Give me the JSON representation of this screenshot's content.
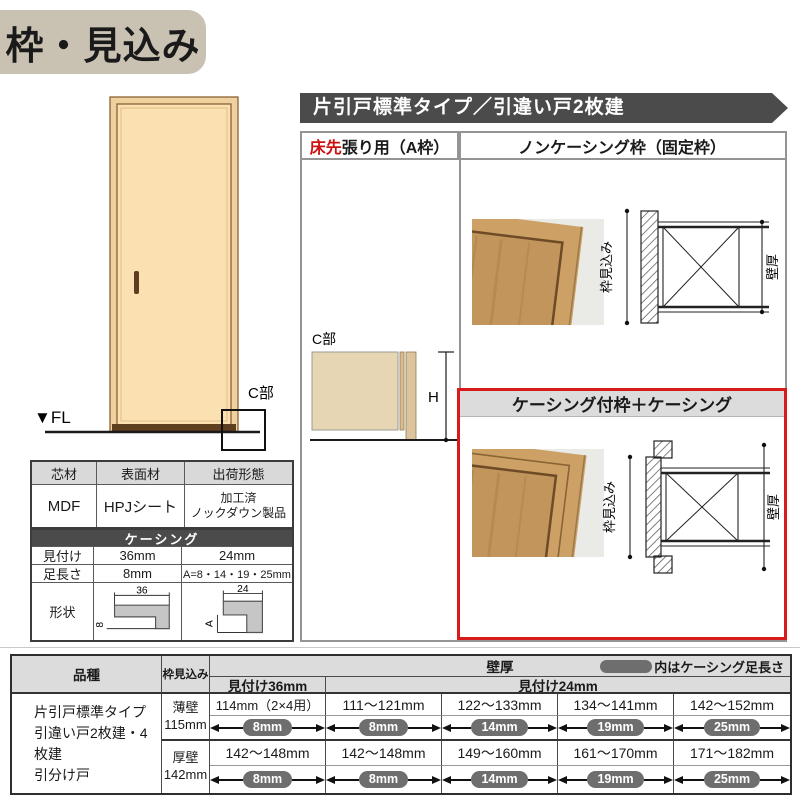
{
  "title": "枠・見込み",
  "colors": {
    "accent_red": "#cc1111",
    "border_red": "#d71a1a",
    "bar_gray": "#4b4b4b",
    "pill_gray": "#6e6e6e",
    "header_gray": "#dcdcdc",
    "title_bg": "#c9c1b2",
    "door_tan": "#fbe0b2"
  },
  "elevation": {
    "fl_label": "▼FL",
    "c_label": "C部"
  },
  "material_table": {
    "headers": [
      "芯材",
      "表面材",
      "出荷形態"
    ],
    "core": "MDF",
    "surface": "HPJシート",
    "shipping_line1": "加工済",
    "shipping_line2": "ノックダウン製品"
  },
  "casing_table": {
    "title": "ケーシング",
    "row_mitsuke": {
      "label": "見付け",
      "v36": "36mm",
      "v24": "24mm"
    },
    "row_ashinaga": {
      "label": "足長さ",
      "v36": "8mm",
      "v24": "A=8・14・19・25mm"
    },
    "row_keijo": {
      "label": "形状"
    },
    "shape36": {
      "w": "36",
      "h": "8"
    },
    "shape24": {
      "w": "24",
      "h": "A"
    }
  },
  "section_bar": "片引戸標準タイプ／引違い戸2枚建",
  "panel": {
    "left_header_red": "床先",
    "left_header_rest": "張り用（A枠）",
    "right_header": "ノンケーシング枠（固定枠）",
    "casing_header": "ケーシング付枠＋ケーシング",
    "c_label": "C部",
    "h_label": "H",
    "dim_depth": "枠見込み",
    "dim_wall": "壁厚"
  },
  "bottom_table": {
    "h_product": "品種",
    "h_depth": "枠見込み",
    "h_wall": "壁厚",
    "h_legend": "内はケーシング足長さ",
    "h_m36": "見付け36mm",
    "h_m24": "見付け24mm",
    "product_lines": [
      "片引戸標準タイプ",
      "引違い戸2枚建・4枚建",
      "引分け戸"
    ],
    "rows": [
      {
        "wall": "薄壁",
        "mm": "115mm",
        "cells": [
          {
            "range": "114mm（2×4用）",
            "leg": "8mm"
          },
          {
            "range": "111～121mm",
            "leg": "8mm"
          },
          {
            "range": "122～133mm",
            "leg": "14mm"
          },
          {
            "range": "134～141mm",
            "leg": "19mm"
          },
          {
            "range": "142～152mm",
            "leg": "25mm"
          }
        ]
      },
      {
        "wall": "厚壁",
        "mm": "142mm",
        "cells": [
          {
            "range": "142～148mm",
            "leg": "8mm"
          },
          {
            "range": "142～148mm",
            "leg": "8mm"
          },
          {
            "range": "149～160mm",
            "leg": "14mm"
          },
          {
            "range": "161～170mm",
            "leg": "19mm"
          },
          {
            "range": "171～182mm",
            "leg": "25mm"
          }
        ]
      }
    ]
  }
}
